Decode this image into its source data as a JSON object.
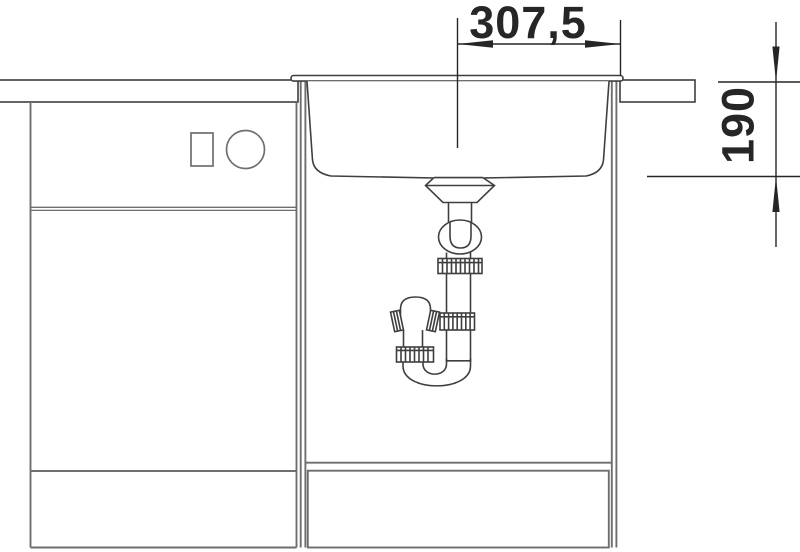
{
  "drawing": {
    "kind": "technical line drawing",
    "subject": "kitchen sink cross-section with undersink siphon and base cabinets",
    "dimensions": {
      "width_half": {
        "label": "307,5"
      },
      "depth": {
        "label": "190"
      }
    }
  },
  "colors": {
    "bg": "#ffffff",
    "line": "#3f3f3f",
    "cabinet": "#6e6e6e",
    "dim": "#262626"
  }
}
